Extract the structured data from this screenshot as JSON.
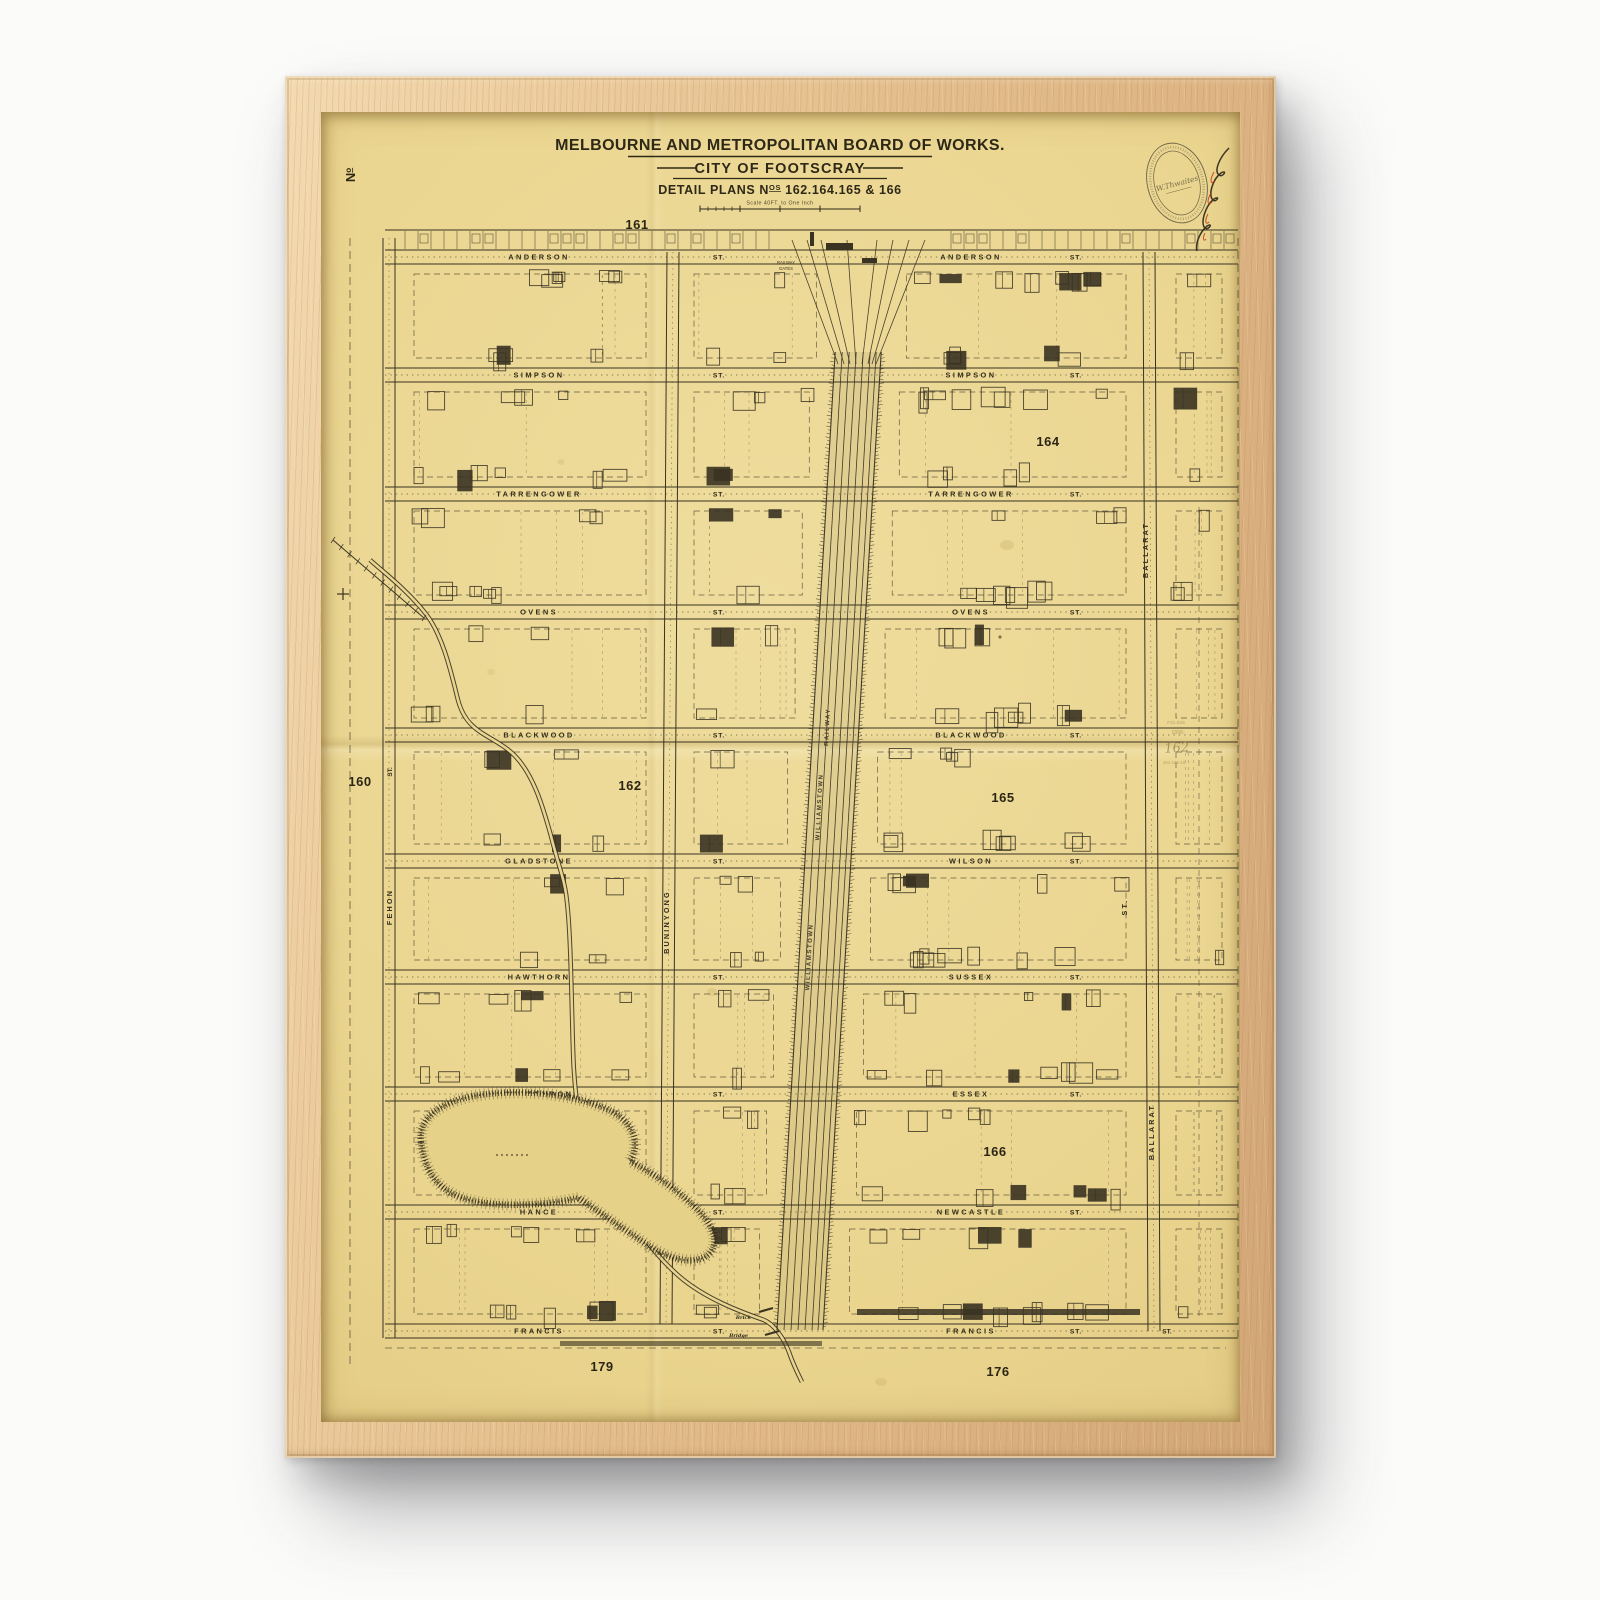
{
  "artwork": {
    "frame_wood_color": "#e3bd8c",
    "paper_color": "#ead58f",
    "ink_color": "#3a3322"
  },
  "map": {
    "corner_no_prefix": "N",
    "corner_no_sup": "o",
    "header": {
      "line1": "MELBOURNE AND METROPOLITAN BOARD OF WORKS.",
      "line2": "CITY OF FOOTSCRAY",
      "line3_prefix": "DETAIL PLANS N",
      "line3_sup": "OS",
      "line3_rest": " 162.164.165 & 166",
      "scale_label": "Scale  40FT. to One Inch"
    },
    "plan_numbers": [
      {
        "n": "161",
        "x": 316,
        "y": 117
      },
      {
        "n": "160",
        "x": 39,
        "y": 674
      },
      {
        "n": "162",
        "x": 309,
        "y": 678
      },
      {
        "n": "164",
        "x": 727,
        "y": 334
      },
      {
        "n": "165",
        "x": 682,
        "y": 690
      },
      {
        "n": "166",
        "x": 674,
        "y": 1044
      },
      {
        "n": "179",
        "x": 281,
        "y": 1259
      },
      {
        "n": "176",
        "x": 677,
        "y": 1264
      }
    ],
    "street_rows": [
      {
        "y": 145,
        "west": "ANDERSON",
        "west_st": "ST.",
        "east": "ANDERSON",
        "east_st": "ST."
      },
      {
        "y": 263,
        "west": "SIMPSON",
        "west_st": "ST.",
        "east": "SIMPSON",
        "east_st": "ST."
      },
      {
        "y": 382,
        "west": "TARRENGOWER",
        "west_st": "ST.",
        "east": "TARRENGOWER",
        "east_st": "ST."
      },
      {
        "y": 500,
        "west": "OVENS",
        "west_st": "ST.",
        "east": "OVENS",
        "east_st": "ST."
      },
      {
        "y": 623,
        "west": "BLACKWOOD",
        "west_st": "ST.",
        "east": "BLACKWOOD",
        "east_st": "ST."
      },
      {
        "y": 749,
        "west": "GLADSTONE",
        "west_st": "ST.",
        "east": "WILSON",
        "east_st": "ST."
      },
      {
        "y": 865,
        "west": "HAWTHORN",
        "west_st": "ST.",
        "east": "SUSSEX",
        "east_st": "ST."
      },
      {
        "y": 982,
        "west": "CLARENDON",
        "west_st": "ST.",
        "east": "ESSEX",
        "east_st": "ST."
      },
      {
        "y": 1100,
        "west": "HANCE",
        "west_st": "ST.",
        "east": "NEWCASTLE",
        "east_st": "ST."
      },
      {
        "y": 1219,
        "west": "FRANCIS",
        "west_st": "ST.",
        "east": "FRANCIS",
        "east_st": "ST.",
        "east_st2": "ST."
      }
    ],
    "vertical_streets": [
      {
        "name": "FEHON",
        "x": 71,
        "y": 795,
        "st": "ST.",
        "st_y": 660
      },
      {
        "name": "BUNINYONG",
        "x": 348,
        "y": 810
      },
      {
        "name": "BALLARAT",
        "x": 827,
        "y": 438
      },
      {
        "name": "BALLARAT",
        "x": 833,
        "y": 1020
      },
      {
        "name": "ST.",
        "x": 806,
        "y": 795
      }
    ],
    "railway": {
      "name_labels": [
        {
          "text": "RAILWAY",
          "x": 508,
          "y": 615
        },
        {
          "text": "WILLIAMSTOWN",
          "x": 500,
          "y": 695
        },
        {
          "text": "WILLIAMSTOWN",
          "x": 490,
          "y": 845
        }
      ],
      "gates_line1": "RAILWAY",
      "gates_line2": "GATES"
    },
    "bridge_line1": "Brick",
    "bridge_line2": "Bridge",
    "stamp": {
      "signature": "W.Thwaites"
    },
    "pencil_notes": [
      "F21.016",
      "1898-",
      "162",
      "164.165.16"
    ]
  }
}
